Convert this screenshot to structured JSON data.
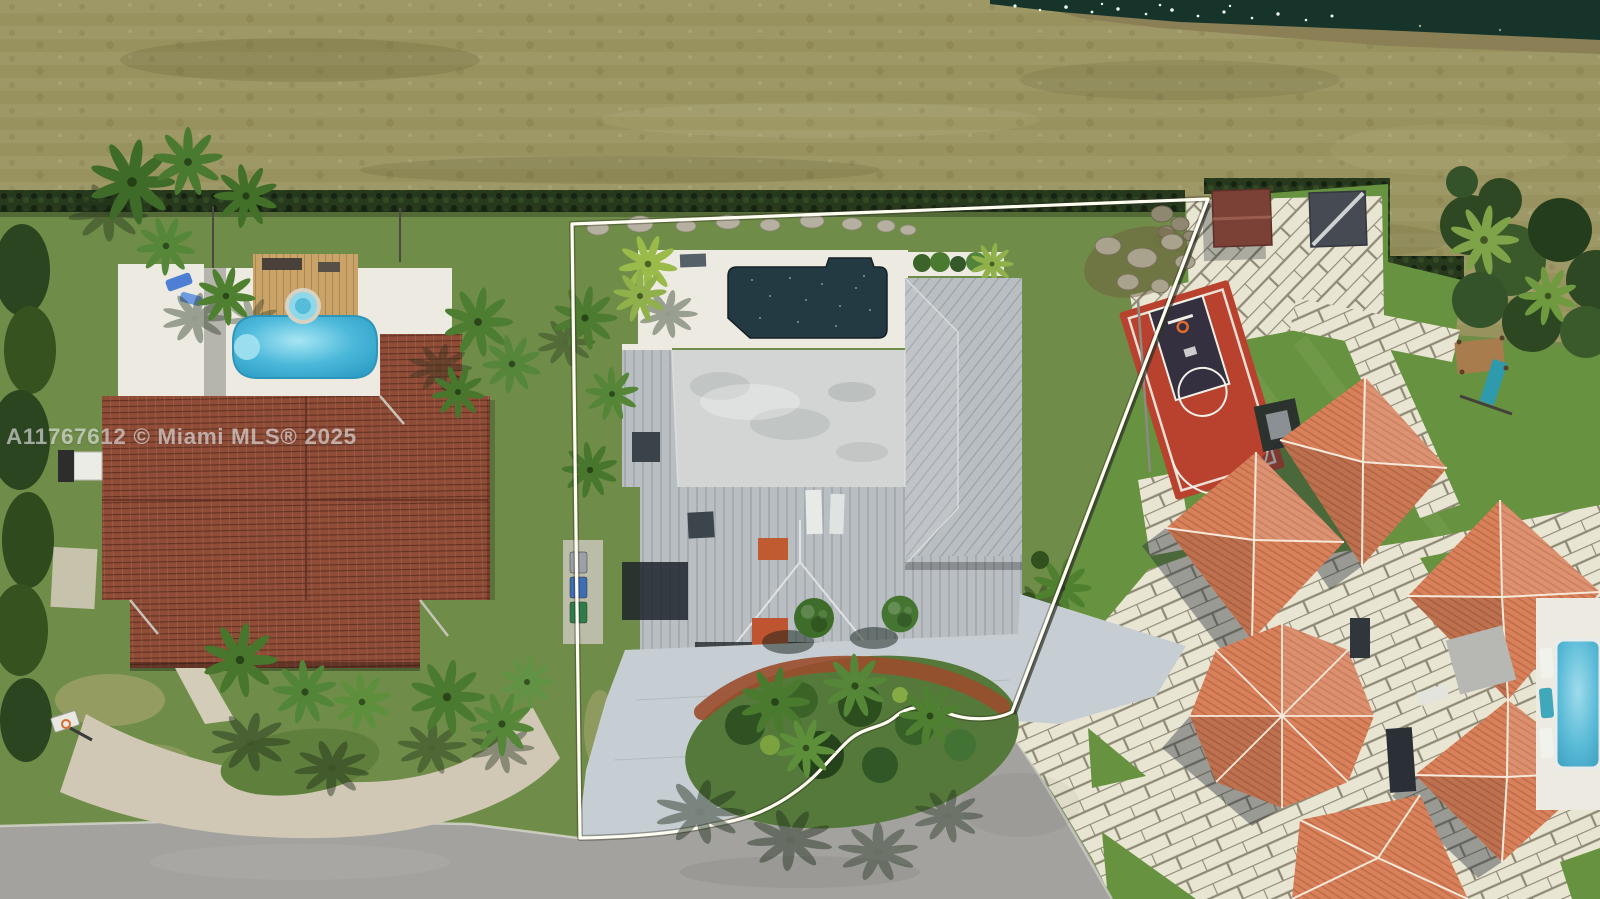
{
  "watermark": {
    "text": "A11767612 © Miami MLS® 2025"
  },
  "scene": {
    "description": "Aerial drone photo of three residential lots; the center lot is outlined with a white property boundary line"
  },
  "colors": {
    "lawn_green": "#6f8d48",
    "berm_grass": "#98925e",
    "water": "#17342a",
    "hedge": "#26391d",
    "turf": "#67923f",
    "paver": "#e9e5d3",
    "road": "#a3a29e",
    "concrete_driveway": "#c6ced3",
    "beige_driveway": "#d0c8b4",
    "pool_deck": "#eceae1",
    "dark_pool": "#233a43",
    "blue_pool": "#4cb9da",
    "mansion_pool": "#58bad6",
    "wood_deck": "#c9a368",
    "red_tile_roof": "#8f4c37",
    "metal_roof": "#b9bec2",
    "flat_roof": "#d2d5d3",
    "orange_tile_roof": "#d8815a",
    "court_red": "#b8422e",
    "court_key": "#34303f",
    "court_lines": "#f2f0e8",
    "boundary_line": "#fffdf2",
    "mulch": "#9a4c2c",
    "palm_green": "#4d7c30",
    "shadow": "#1f2f1a"
  }
}
